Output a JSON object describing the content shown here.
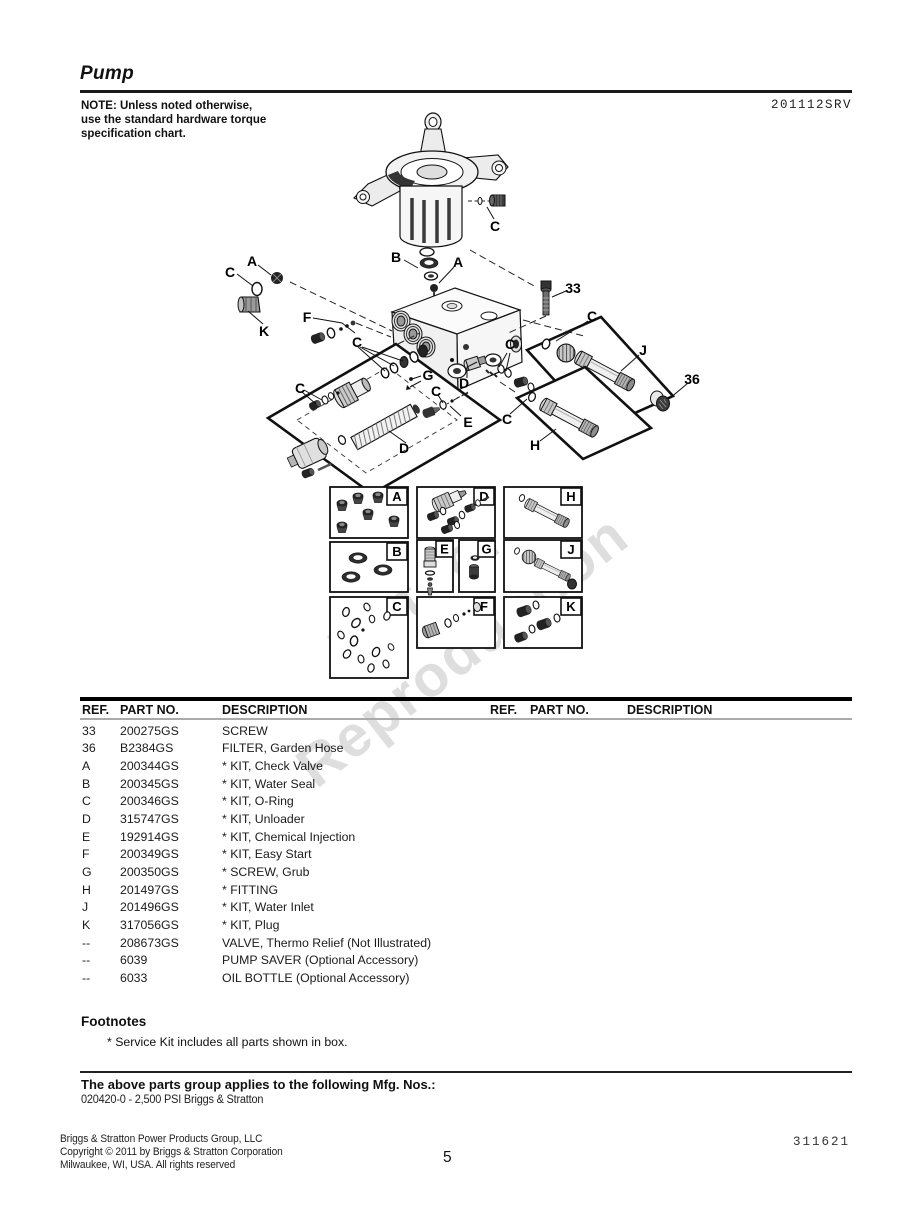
{
  "header": {
    "title": "Pump",
    "doc_number": "201112SRV",
    "note": "NOTE: Unless noted otherwise,\nuse the standard hardware torque\nspecification chart."
  },
  "watermark": {
    "line1": "Not for",
    "line2": "Reproduction"
  },
  "diagram": {
    "labels": [
      "C",
      "A",
      "K",
      "C",
      "B",
      "A",
      "33",
      "C",
      "J",
      "36",
      "F",
      "C",
      "C",
      "G",
      "D",
      "C",
      "C",
      "E",
      "C",
      "H",
      "D"
    ],
    "kits": [
      "A",
      "D",
      "H",
      "B",
      "E",
      "G",
      "J",
      "C",
      "F",
      "K"
    ]
  },
  "parts_table": {
    "headers": [
      "REF.",
      "PART NO.",
      "DESCRIPTION"
    ],
    "rows": [
      {
        "ref": "33",
        "part": "200275GS",
        "desc": "SCREW"
      },
      {
        "ref": "36",
        "part": "B2384GS",
        "desc": "FILTER, Garden Hose"
      },
      {
        "ref": "A",
        "part": "200344GS",
        "desc": "* KIT, Check Valve"
      },
      {
        "ref": "B",
        "part": "200345GS",
        "desc": "* KIT, Water Seal"
      },
      {
        "ref": "C",
        "part": "200346GS",
        "desc": "* KIT, O-Ring"
      },
      {
        "ref": "D",
        "part": "315747GS",
        "desc": "* KIT, Unloader"
      },
      {
        "ref": "E",
        "part": "192914GS",
        "desc": "* KIT, Chemical Injection"
      },
      {
        "ref": "F",
        "part": "200349GS",
        "desc": "* KIT, Easy Start"
      },
      {
        "ref": "G",
        "part": "200350GS",
        "desc": "* SCREW, Grub"
      },
      {
        "ref": "H",
        "part": "201497GS",
        "desc": "* FITTING"
      },
      {
        "ref": "J",
        "part": "201496GS",
        "desc": "* KIT, Water Inlet"
      },
      {
        "ref": "K",
        "part": "317056GS",
        "desc": "* KIT, Plug"
      },
      {
        "ref": "--",
        "part": "208673GS",
        "desc": "VALVE, Thermo Relief (Not Illustrated)"
      },
      {
        "ref": "--",
        "part": "6039",
        "desc": "PUMP SAVER (Optional Accessory)"
      },
      {
        "ref": "--",
        "part": "6033",
        "desc": "OIL BOTTLE (Optional Accessory)"
      }
    ]
  },
  "footnotes": {
    "heading": "Footnotes",
    "item": "* Service Kit includes all parts shown in box."
  },
  "mfg": {
    "heading": "The above parts group applies to the following Mfg. Nos.:",
    "value": "020420-0 - 2,500 PSI Briggs & Stratton"
  },
  "footer": {
    "line1": "Briggs & Stratton Power Products Group, LLC",
    "line2": "Copyright ©  2011 by Briggs & Stratton Corporation",
    "line3": "Milwaukee, WI, USA. All rights reserved",
    "page_number": "5",
    "doc_code": "311621"
  }
}
